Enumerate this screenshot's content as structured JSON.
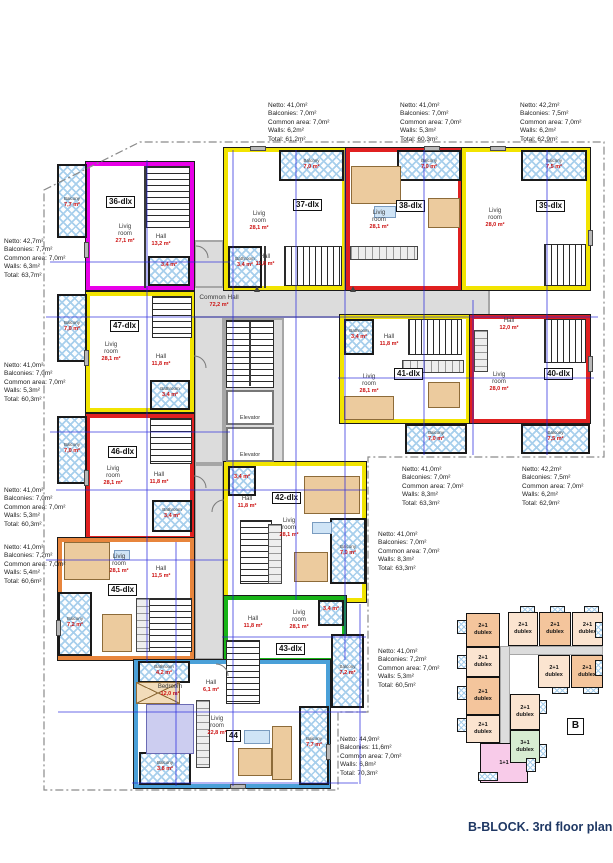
{
  "title": "B-BLOCK. 3rd floor plan",
  "labels": {
    "common_hall": "Common Hall",
    "common_hall_area": "72,2 m²",
    "elevator": "Elevator",
    "living_room": "Livig room",
    "hall": "Hall",
    "balcony": "Balcony",
    "bedroom": "Bedroom",
    "bathroom": "Bathroom"
  },
  "units": {
    "u36": {
      "id": "36-dlx",
      "living": "27,1 m²",
      "hall": "13,2 m²",
      "balcony": "7,7 m²",
      "bathroom": "3,4 m²",
      "spec": {
        "netto": "Netto: 42,7m²",
        "balconies": "Balconies: 7,7m²",
        "common": "Common area: 7,0m²",
        "walls": "Walls: 6,3m²",
        "total": "Total: 63,7m²"
      }
    },
    "u37": {
      "id": "37-dlx",
      "living": "28,1 m²",
      "hall": "11,8 m²",
      "balcony": "7,0 m²",
      "bathroom": "3,4 m²",
      "spec": {
        "netto": "Netto: 41,0m²",
        "balconies": "Balconies: 7,0m²",
        "common": "Common area: 7,0m²",
        "walls": "Walls: 6,2m²",
        "total": "Total: 61,2m²"
      }
    },
    "u38": {
      "id": "38-dlx",
      "living": "28,1 m²",
      "balcony": "7,0 m²",
      "spec": {
        "netto": "Netto: 41,0m²",
        "balconies": "Balconies: 7,0m²",
        "common": "Common area: 7,0m²",
        "walls": "Walls: 5,3m²",
        "total": "Total: 60,3m²"
      }
    },
    "u39": {
      "id": "39-dlx",
      "living": "28,0 m²",
      "balcony": "7,5 m²",
      "spec": {
        "netto": "Netto: 42,2m²",
        "balconies": "Balconies: 7,5m²",
        "common": "Common area: 7,0m²",
        "walls": "Walls: 6,2m²",
        "total": "Total: 62,9m²"
      }
    },
    "u40": {
      "id": "40-dlx",
      "living": "28,0 m²",
      "hall": "12,0 m²",
      "balcony": "7,5 m²",
      "spec": {
        "netto": "Netto: 42,2m²",
        "balconies": "Balconies: 7,5m²",
        "common": "Common area: 7,0m²",
        "walls": "Walls: 6,2m²",
        "total": "Total: 62,9m²"
      }
    },
    "u41": {
      "id": "41-dlx",
      "living": "28,1 m²",
      "hall": "11,8 m²",
      "balcony": "7,0 m²",
      "bathroom": "3,4 m²",
      "spec": {
        "netto": "Netto: 41,0m²",
        "balconies": "Balconies: 7,0m²",
        "common": "Common area: 7,0m²",
        "walls": "Walls: 8,3m²",
        "total": "Total: 63,3m²"
      }
    },
    "u42": {
      "id": "42-dlx",
      "living": "28,1 m²",
      "hall": "11,8 m²",
      "balcony": "7,0 m²",
      "bathroom": "3,4 m²",
      "spec": {
        "netto": "Netto: 41,0m²",
        "balconies": "Balconies: 7,0m²",
        "common": "Common area: 7,0m²",
        "walls": "Walls: 8,3m²",
        "total": "Total: 63,3m²"
      }
    },
    "u43": {
      "id": "43-dlx",
      "living": "28,1 m²",
      "hall": "11,8 m²",
      "balcony": "7,2 m²",
      "bathroom": "3,4 m²",
      "spec": {
        "netto": "Netto: 41,0m²",
        "balconies": "Balconies: 7,2m²",
        "common": "Common area: 7,0m²",
        "walls": "Walls: 5,3m²",
        "total": "Total: 60,5m²"
      }
    },
    "u44": {
      "id": "44",
      "living": "22,8 m²",
      "hall": "6,1 m²",
      "bedroom": "12,0 m²",
      "bathroom": "4,2 m²",
      "balcony_left": "3,8 m²",
      "balcony_right": "7,7 m²",
      "spec": {
        "netto": "Netto: 44,9m²",
        "balconies": "Balconies: 11,6m²",
        "common": "Common area: 7,0m²",
        "walls": "Walls: 6,8m²",
        "total": "Total: 70,3m²"
      }
    },
    "u45": {
      "id": "45-dlx",
      "living": "28,1 m²",
      "hall": "11,5 m²",
      "balcony": "7,2 m²",
      "spec": {
        "netto": "Netto: 41,0m²",
        "balconies": "Balconies: 7,2m²",
        "common": "Common area: 7,0m²",
        "walls": "Walls: 5,4m²",
        "total": "Total: 60,6m²"
      }
    },
    "u46": {
      "id": "46-dlx",
      "living": "28,1 m²",
      "hall": "11,8 m²",
      "balcony": "7,0 m²",
      "bathroom": "3,4 m²",
      "spec": {
        "netto": "Netto: 41,0m²",
        "balconies": "Balconies: 7,0m²",
        "common": "Common area: 7,0m²",
        "walls": "Walls: 5,3m²",
        "total": "Total: 60,3m²"
      }
    },
    "u47": {
      "id": "47-dlx",
      "living": "28,1 m²",
      "hall": "11,8 m²",
      "balcony": "7,0 m²",
      "bathroom": "3,4 m²",
      "spec": {
        "netto": "Netto: 41,0m²",
        "balconies": "Balconies: 7,0m²",
        "common": "Common area: 7,0m²",
        "walls": "Walls: 5,3m²",
        "total": "Total: 60,3m²"
      }
    }
  },
  "key_plan": {
    "block": "B",
    "unit_types": {
      "t21": "2+1",
      "t31": "3+1",
      "t11": "1+1",
      "dublex": "dublex"
    }
  },
  "colors": {
    "wall_magenta": "#e800e8",
    "wall_yellow": "#f2e400",
    "wall_red": "#e02020",
    "wall_green": "#18b418",
    "wall_blue": "#4aa0d8",
    "wall_orange": "#e8853c",
    "balcony_hatch": "#a8cfec",
    "hall_fill": "#dcdcdc",
    "dimension_blue": "#2424dd",
    "area_red": "#cc1111",
    "title_navy": "#1f3864",
    "keyplan_peach_dark": "#f4c59c",
    "keyplan_peach_light": "#fbe4d0",
    "keyplan_green": "#d7ecd2",
    "keyplan_pink": "#f8cbe9"
  }
}
